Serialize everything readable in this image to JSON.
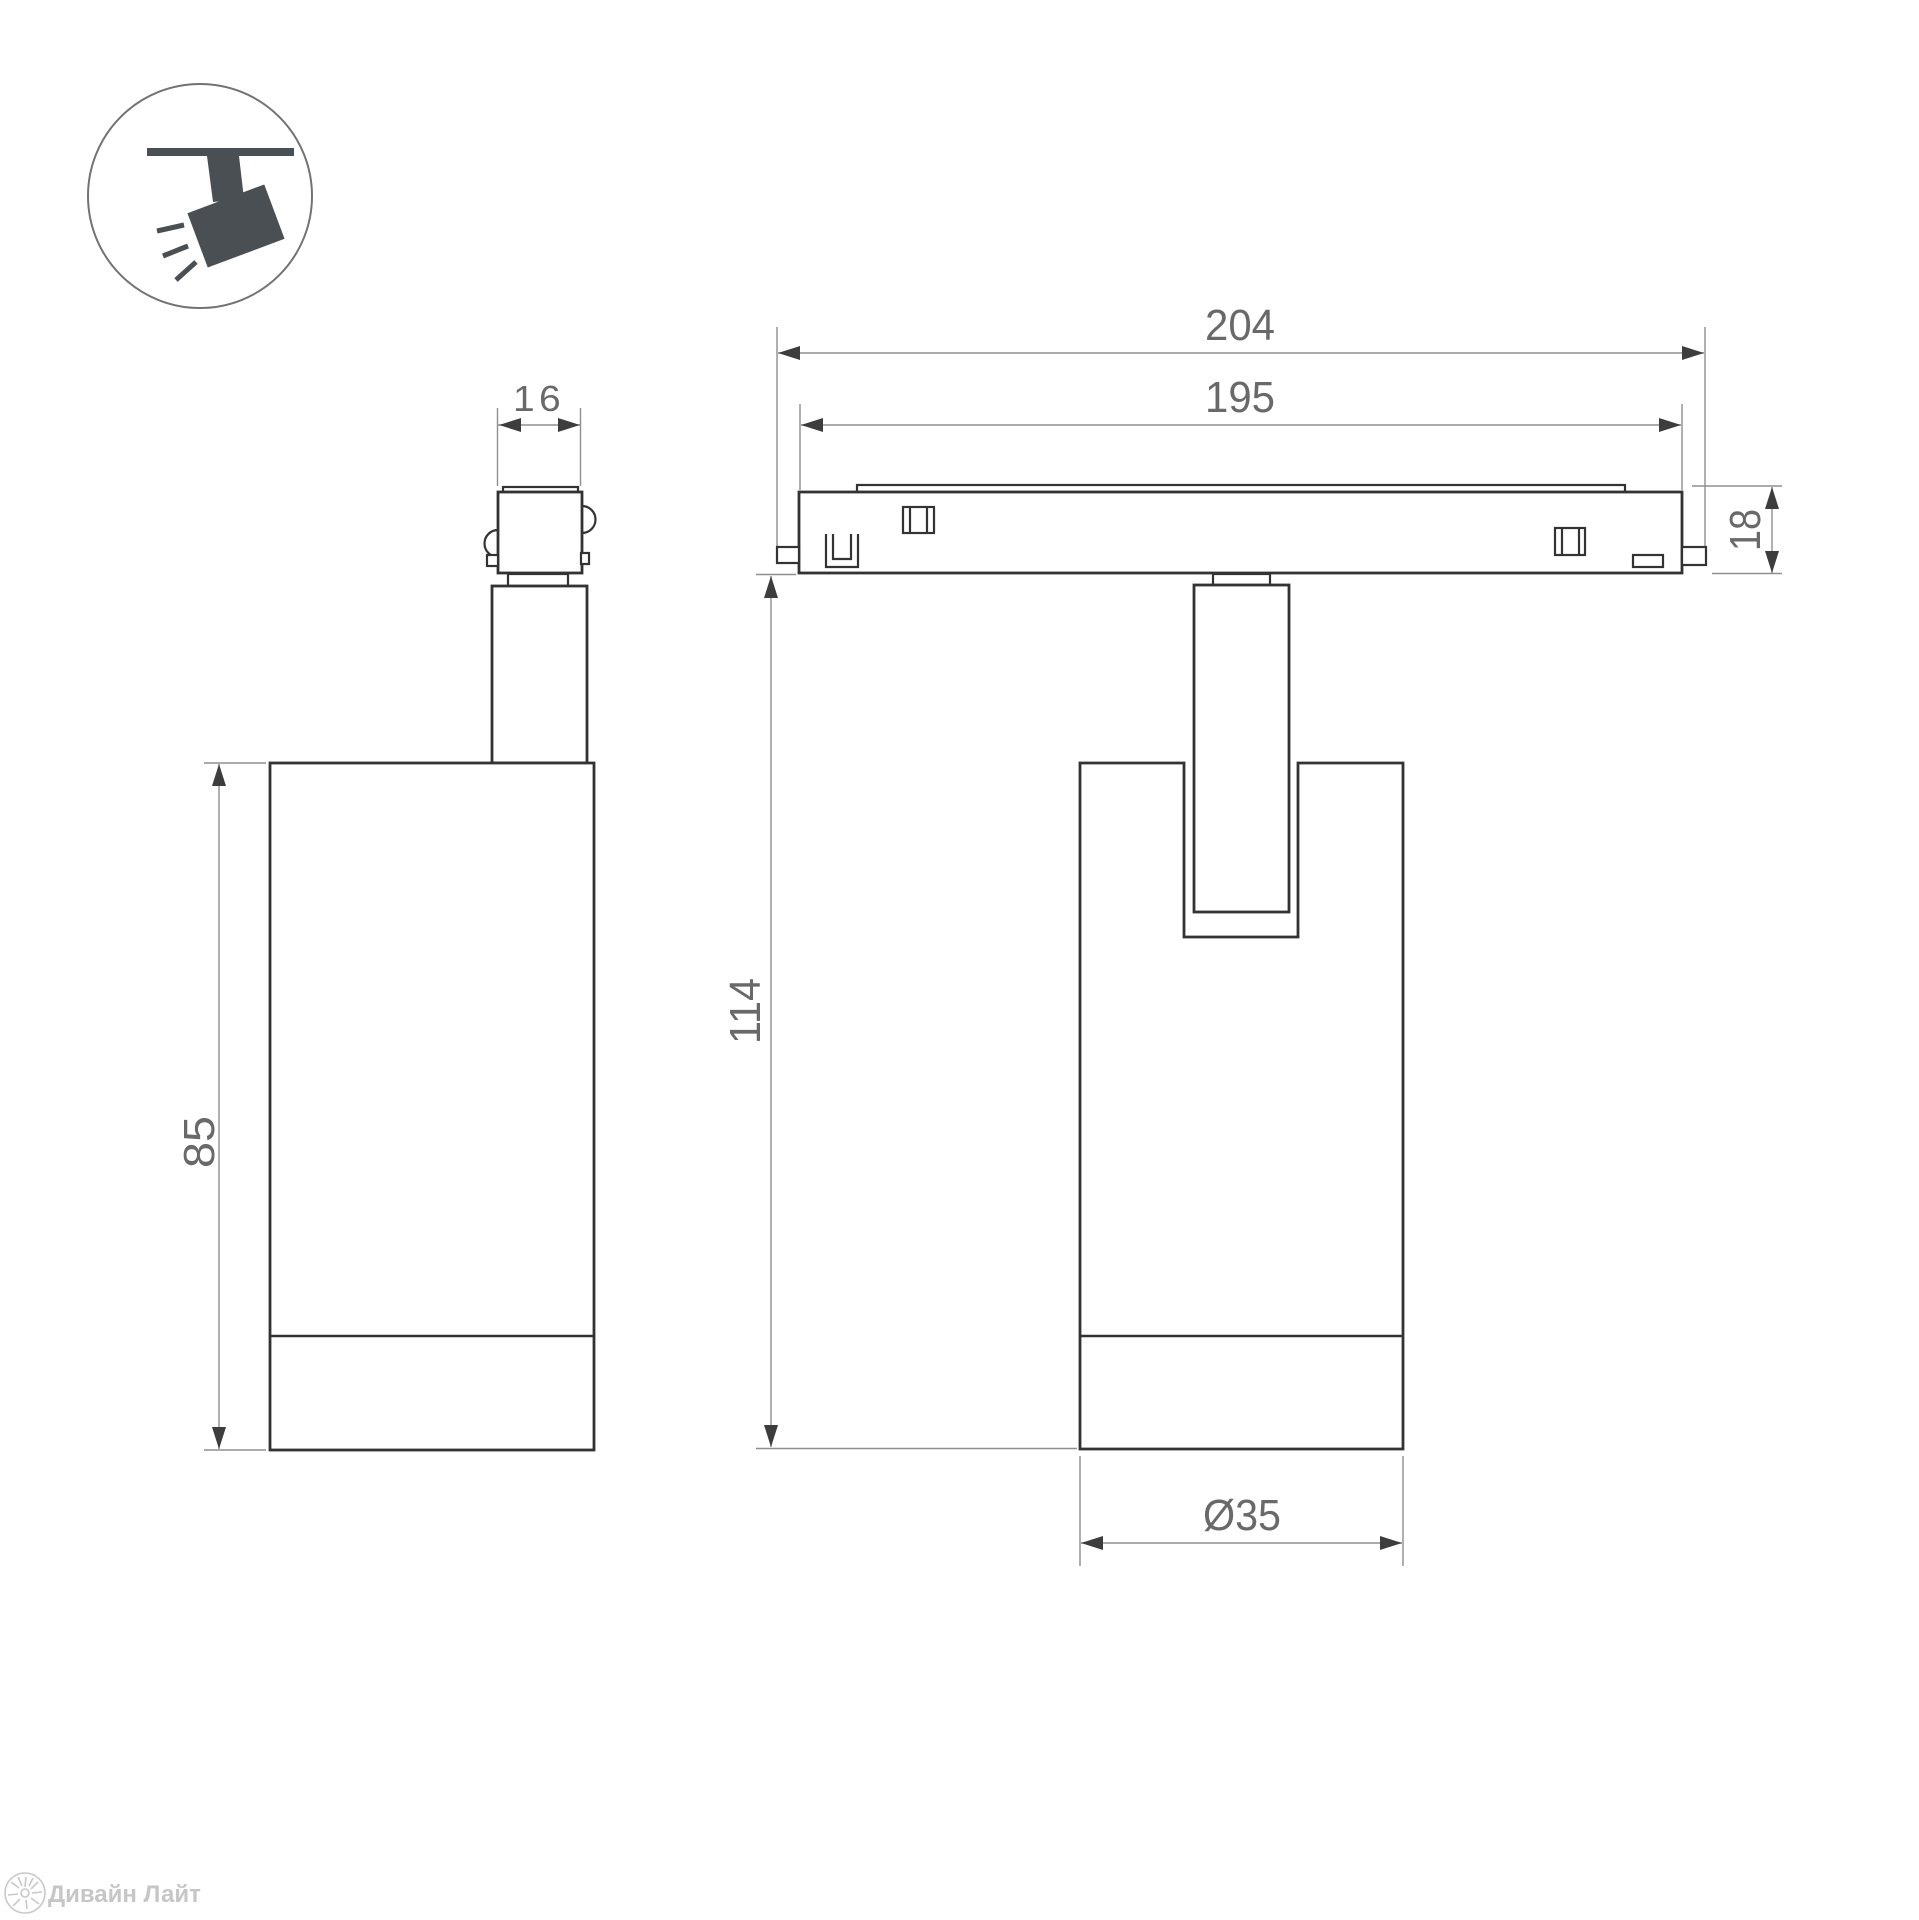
{
  "icon": {
    "name": "track-spotlight"
  },
  "dimensions": {
    "adapter_width": "16",
    "overall_length": "204",
    "body_length": "195",
    "track_height": "18",
    "lamp_height": "85",
    "total_height": "114",
    "diameter": "Ø35"
  },
  "colors": {
    "geometry": "#333333",
    "dimension_line": "#8f8f8f",
    "arrow": "#3d3d3d",
    "dimension_text": "#696969",
    "icon": "#4a4f54",
    "watermark": "#c6c6c6"
  },
  "watermark": {
    "brand": "Дивайн Лайт"
  }
}
